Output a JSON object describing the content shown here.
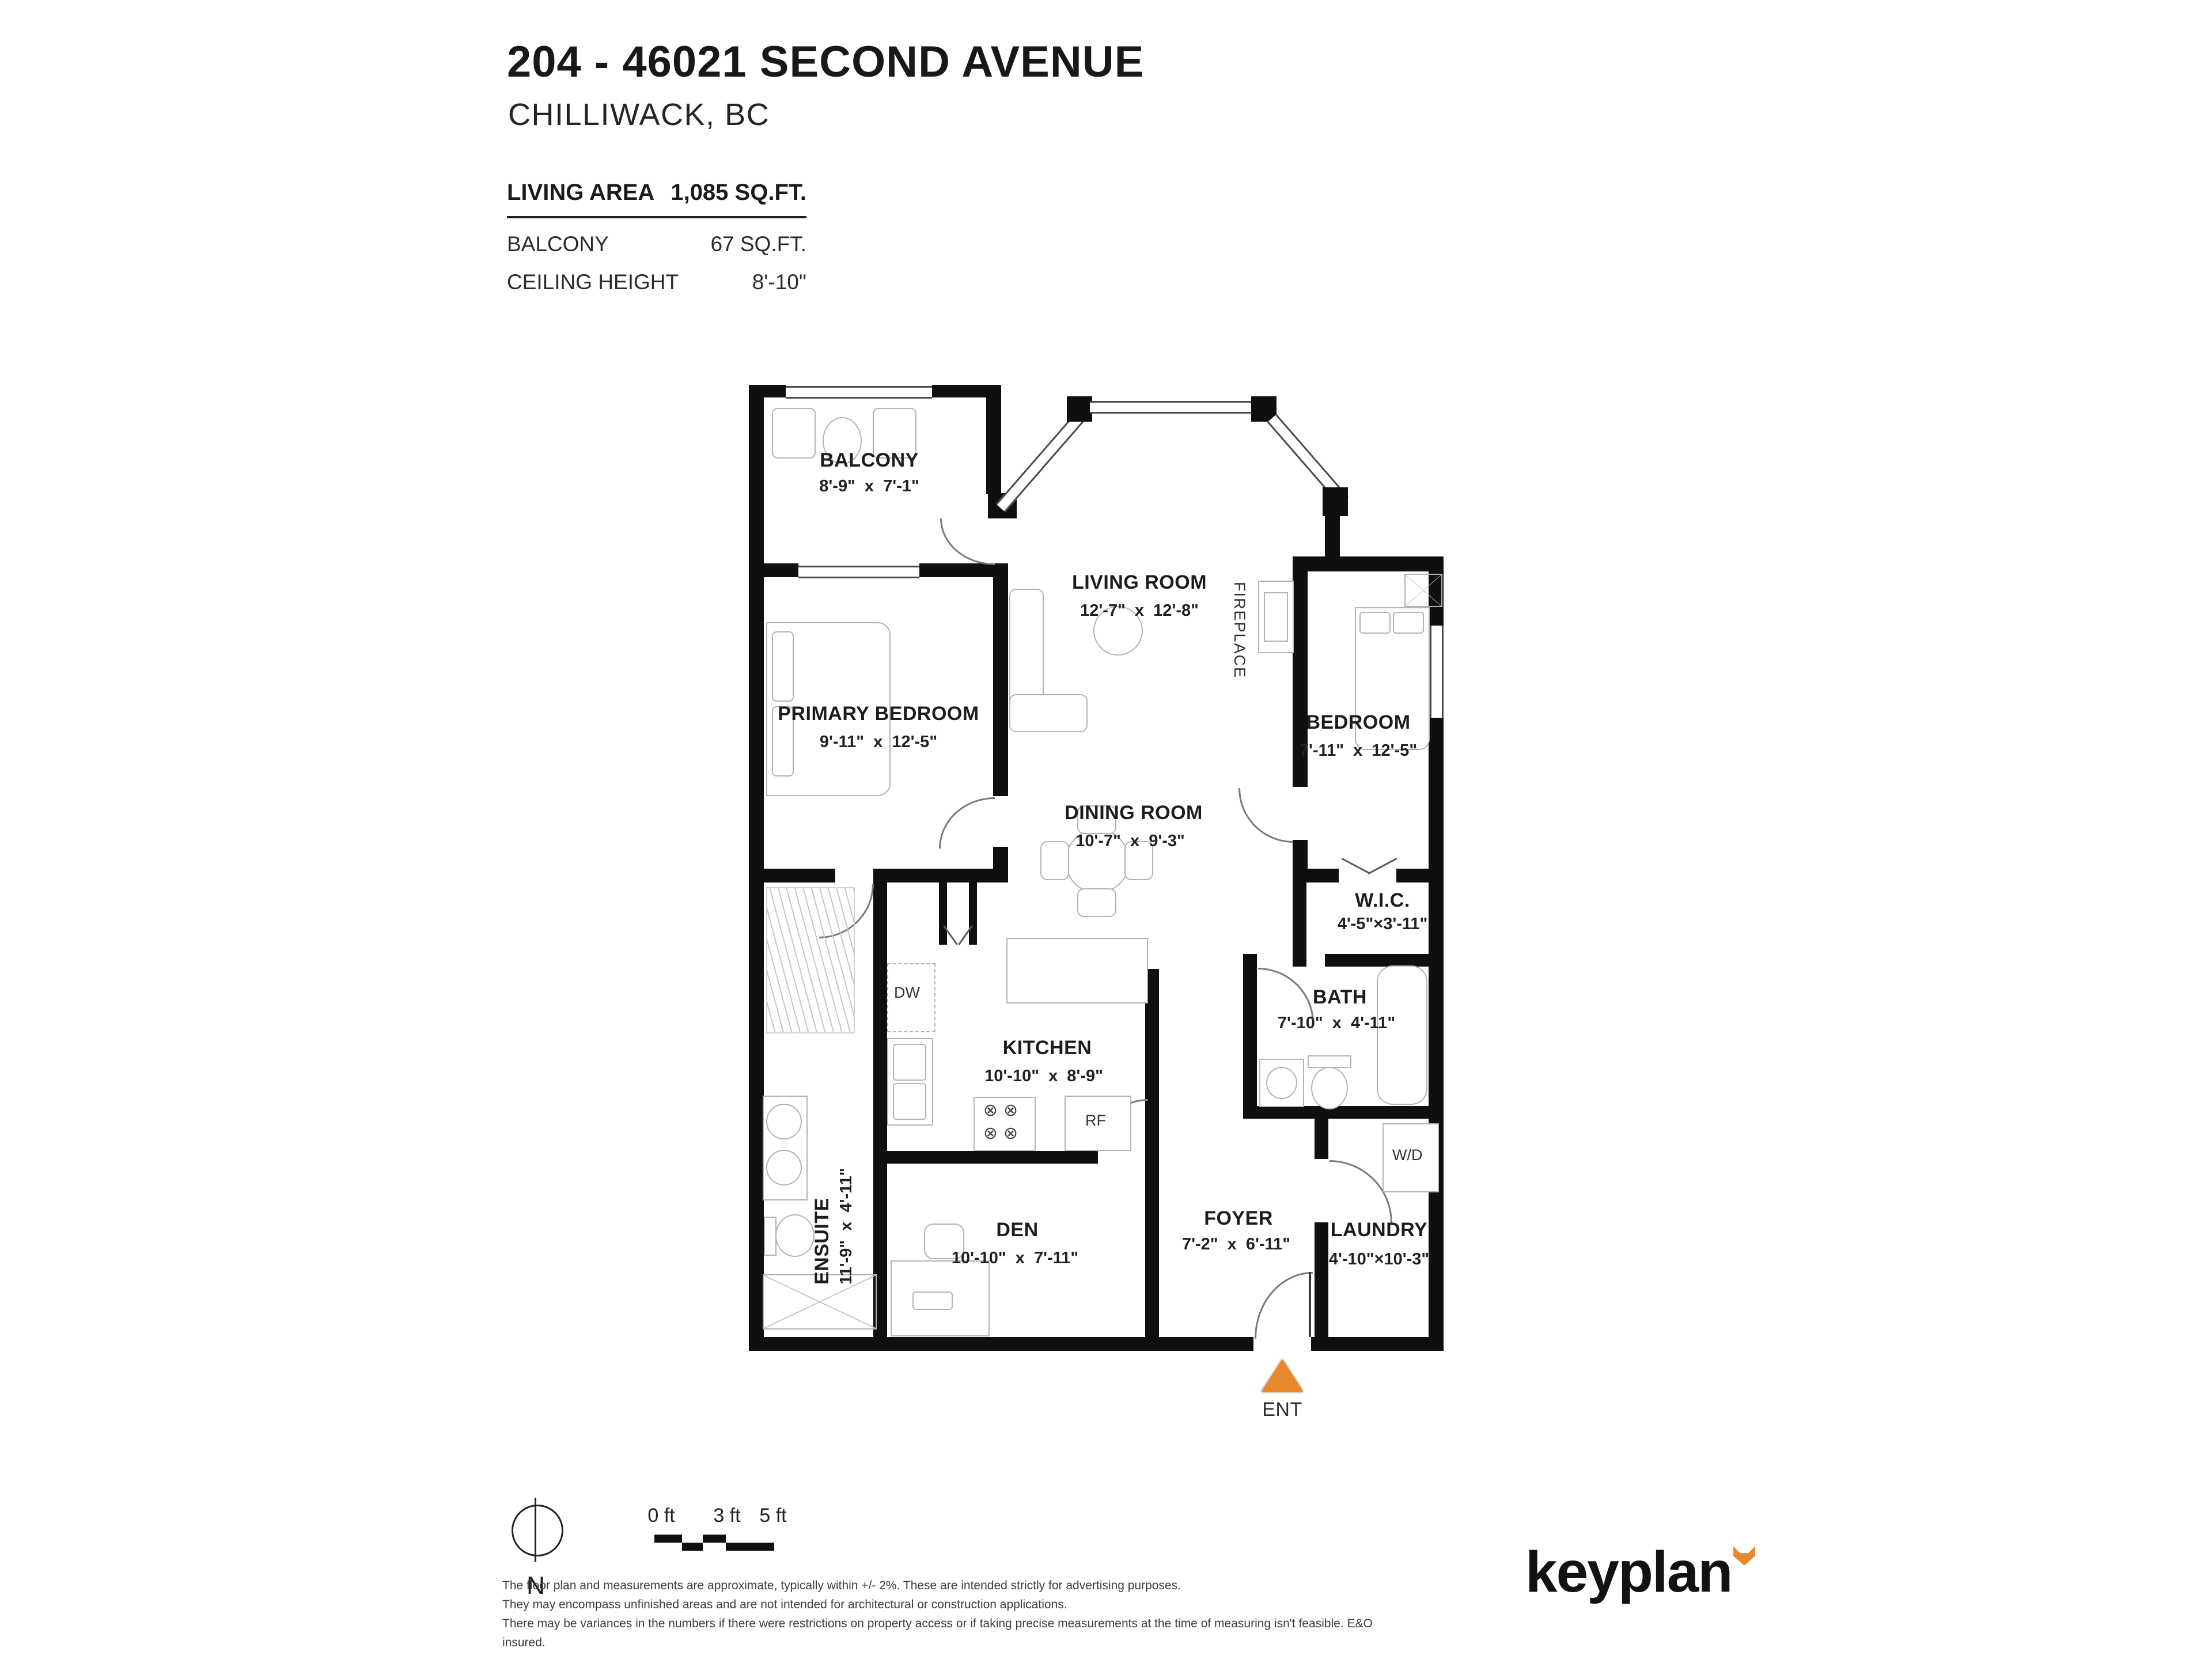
{
  "header": {
    "title": "204 - 46021 SECOND AVENUE",
    "subtitle": "CHILLIWACK, BC"
  },
  "stats": {
    "living_area": {
      "label": "LIVING AREA",
      "value": "1,085 SQ.FT."
    },
    "balcony": {
      "label": "BALCONY",
      "value": "67 SQ.FT."
    },
    "ceiling": {
      "label": "CEILING HEIGHT",
      "value": "8'-10\""
    }
  },
  "rooms": [
    {
      "id": "balcony",
      "name": "BALCONY",
      "dims": "8'-9\"  x  7'-1\""
    },
    {
      "id": "living-room",
      "name": "LIVING ROOM",
      "dims": "12'-7\"  x  12'-8\""
    },
    {
      "id": "primary-bedroom",
      "name": "PRIMARY BEDROOM",
      "dims": "9'-11\"  x  12'-5\""
    },
    {
      "id": "bedroom",
      "name": "BEDROOM",
      "dims": "7'-11\"  x  12'-5\""
    },
    {
      "id": "dining-room",
      "name": "DINING ROOM",
      "dims": "10'-7\"  x  9'-3\""
    },
    {
      "id": "wic",
      "name": "W.I.C.",
      "dims": "4'-5\"×3'-11\""
    },
    {
      "id": "bath",
      "name": "BATH",
      "dims": "7'-10\"  x  4'-11\""
    },
    {
      "id": "kitchen",
      "name": "KITCHEN",
      "dims": "10'-10\"  x  8'-9\""
    },
    {
      "id": "ensuite",
      "name": "ENSUITE",
      "dims": "11'-9\"  x  4'-11\""
    },
    {
      "id": "den",
      "name": "DEN",
      "dims": "10'-10\"  x  7'-11\""
    },
    {
      "id": "foyer",
      "name": "FOYER",
      "dims": "7'-2\"  x  6'-11\""
    },
    {
      "id": "laundry",
      "name": "LAUNDRY",
      "dims": "4'-10\"×10'-3\""
    }
  ],
  "labels": {
    "fireplace": "FIREPLACE",
    "dw": "DW",
    "rf": "RF",
    "wd": "W/D"
  },
  "entry": {
    "label": "ENT"
  },
  "compass": {
    "label": "N"
  },
  "scale": {
    "ticks": [
      "0 ft",
      "3 ft",
      "5 ft"
    ]
  },
  "disclaimer": {
    "lines": [
      "The floor plan and measurements are approximate, typically within +/- 2%. These are intended strictly for advertising purposes.",
      "They may encompass unfinished areas and are not intended for architectural or construction applications.",
      "There may be variances in the numbers if there were restrictions on property access or if taking precise measurements at the time of measuring isn't feasible. E&O insured."
    ]
  },
  "brand": {
    "logo": "keyplan"
  },
  "colors": {
    "accent": "#E8872B",
    "wall": "#0F0F0F"
  }
}
